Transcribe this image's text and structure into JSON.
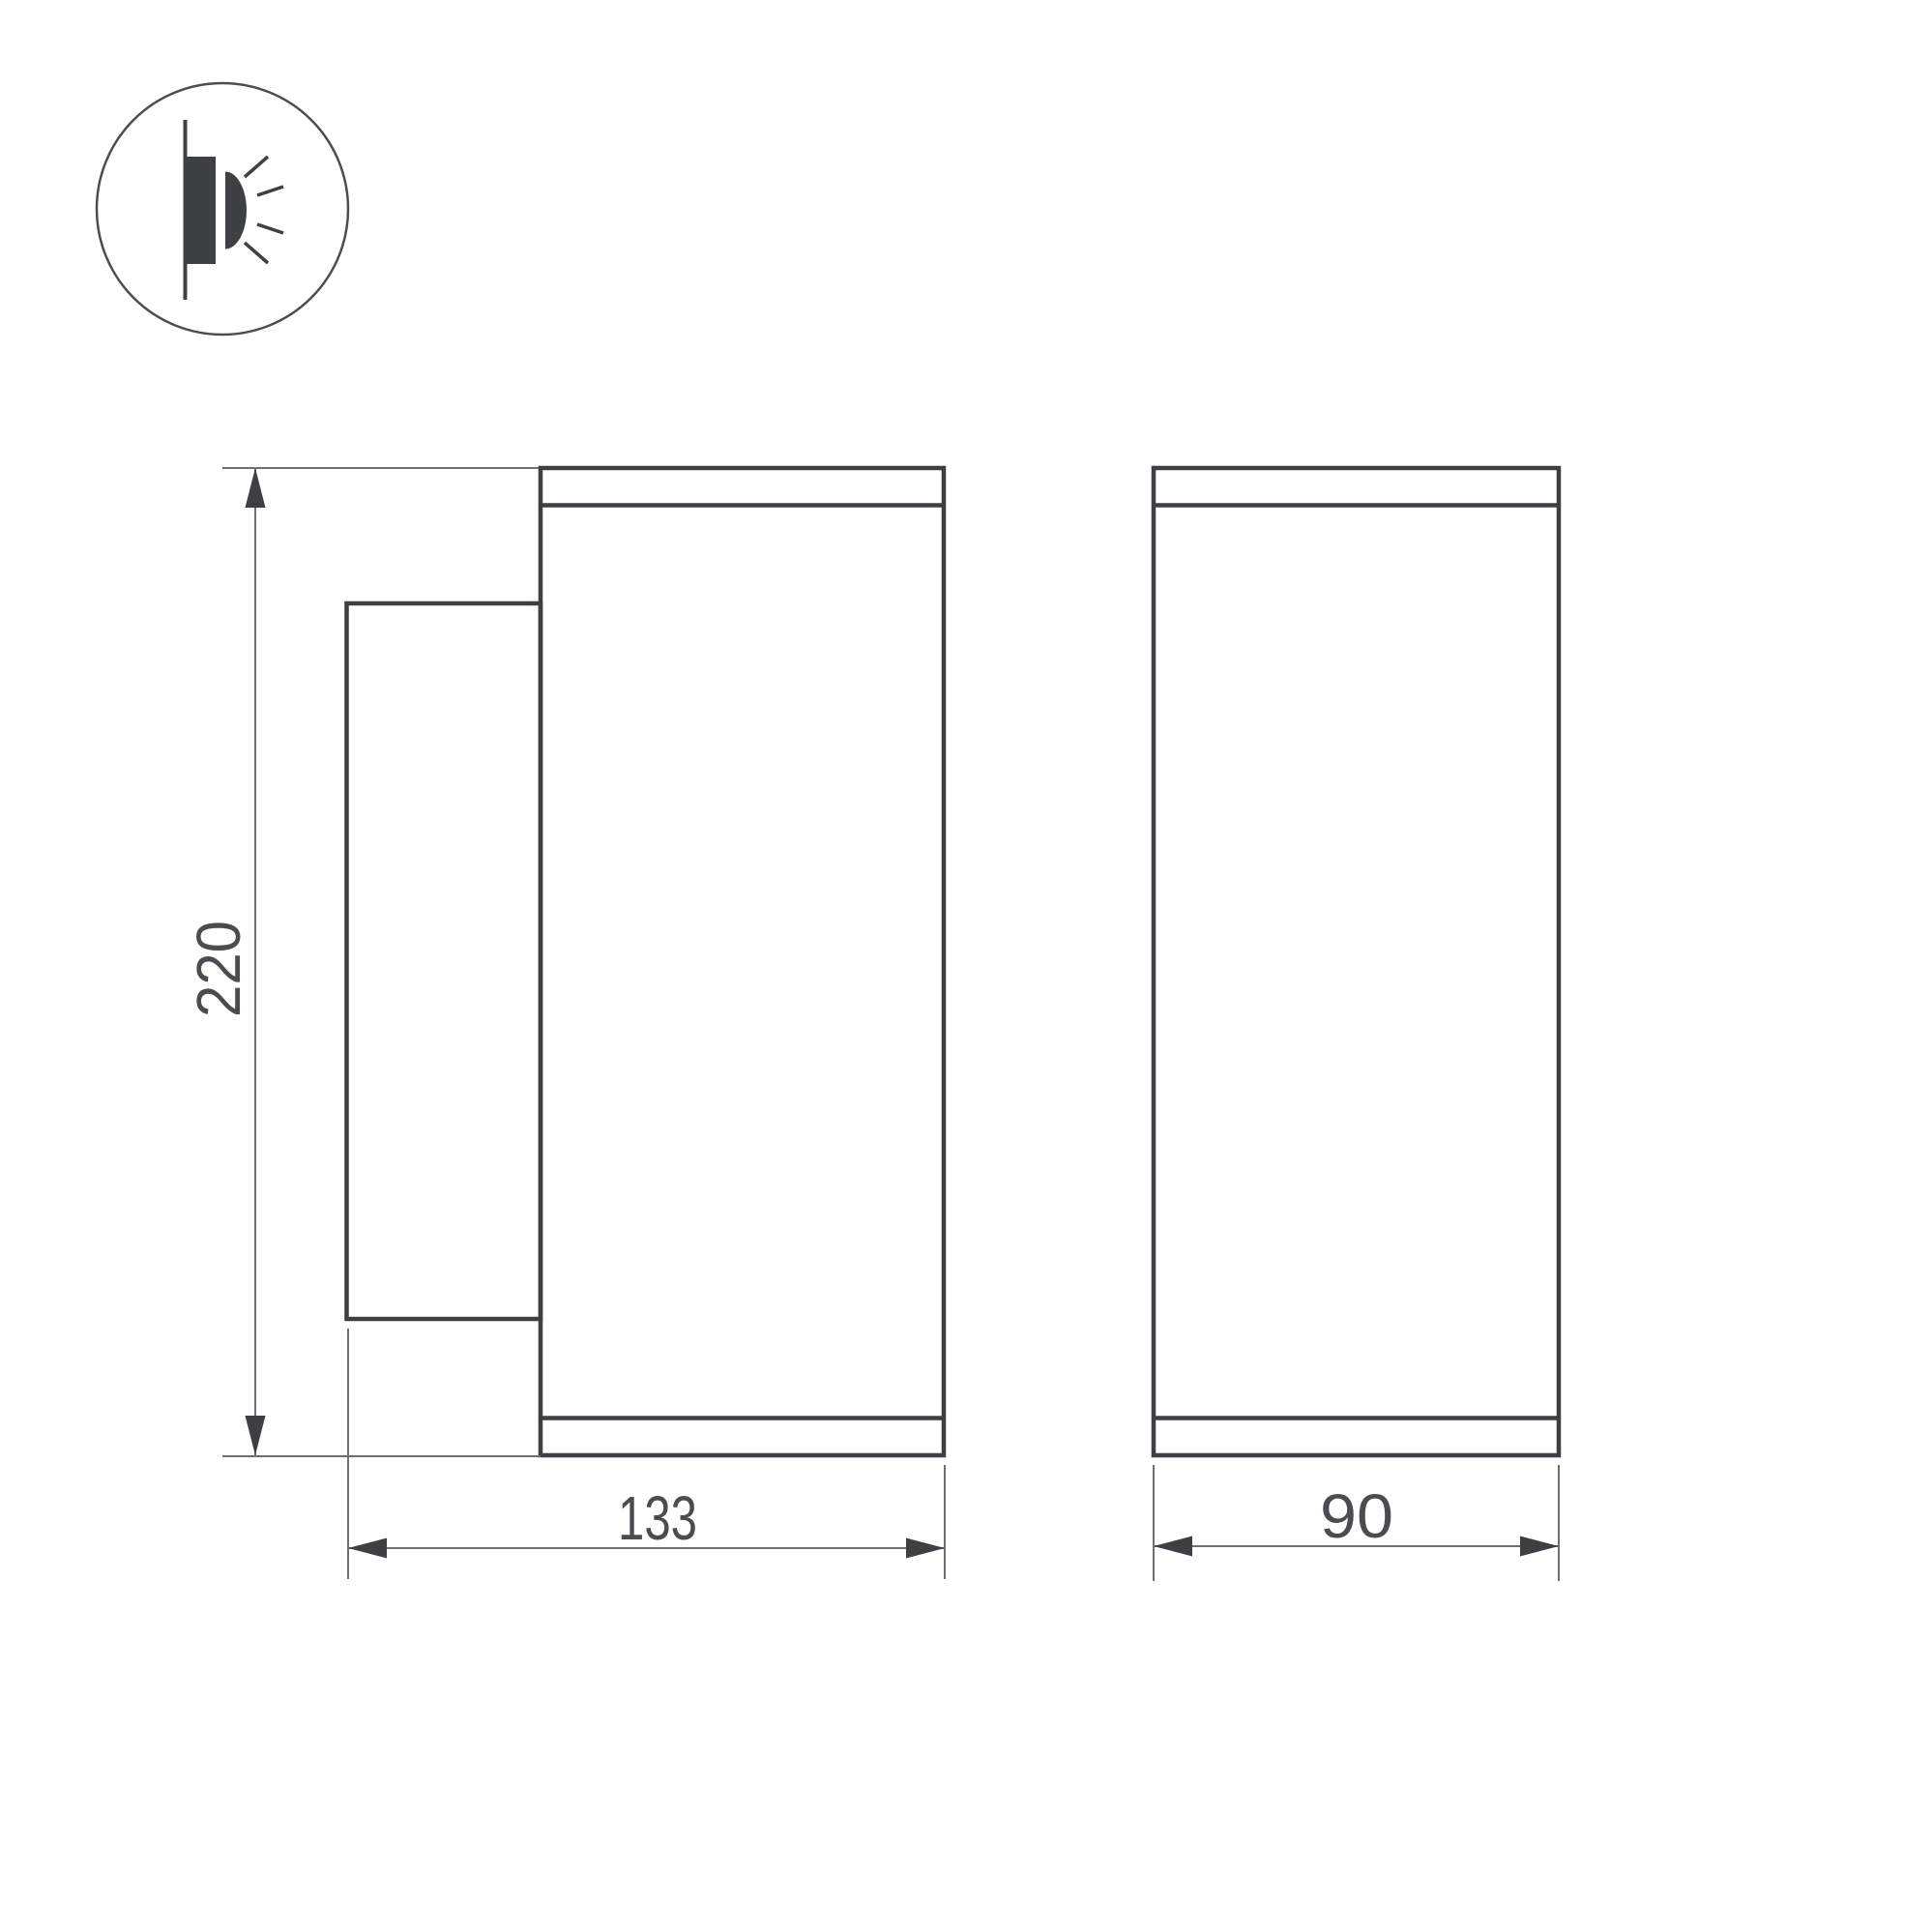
{
  "drawing": {
    "type": "technical-dimension-drawing",
    "icon": "wall-mounted-light-icon",
    "views": [
      "side-view-with-mount-plate",
      "front-view"
    ],
    "dimensions": {
      "height_label": "220",
      "depth_label": "133",
      "width_label": "90"
    }
  },
  "colors": {
    "outline": "#3e3f43",
    "dim_line": "#6e6f73",
    "arrow": "#3e3f43",
    "label": "#4b4c50",
    "icon": "#3f4044",
    "circle": "#4c4d51",
    "background": "#ffffff"
  }
}
